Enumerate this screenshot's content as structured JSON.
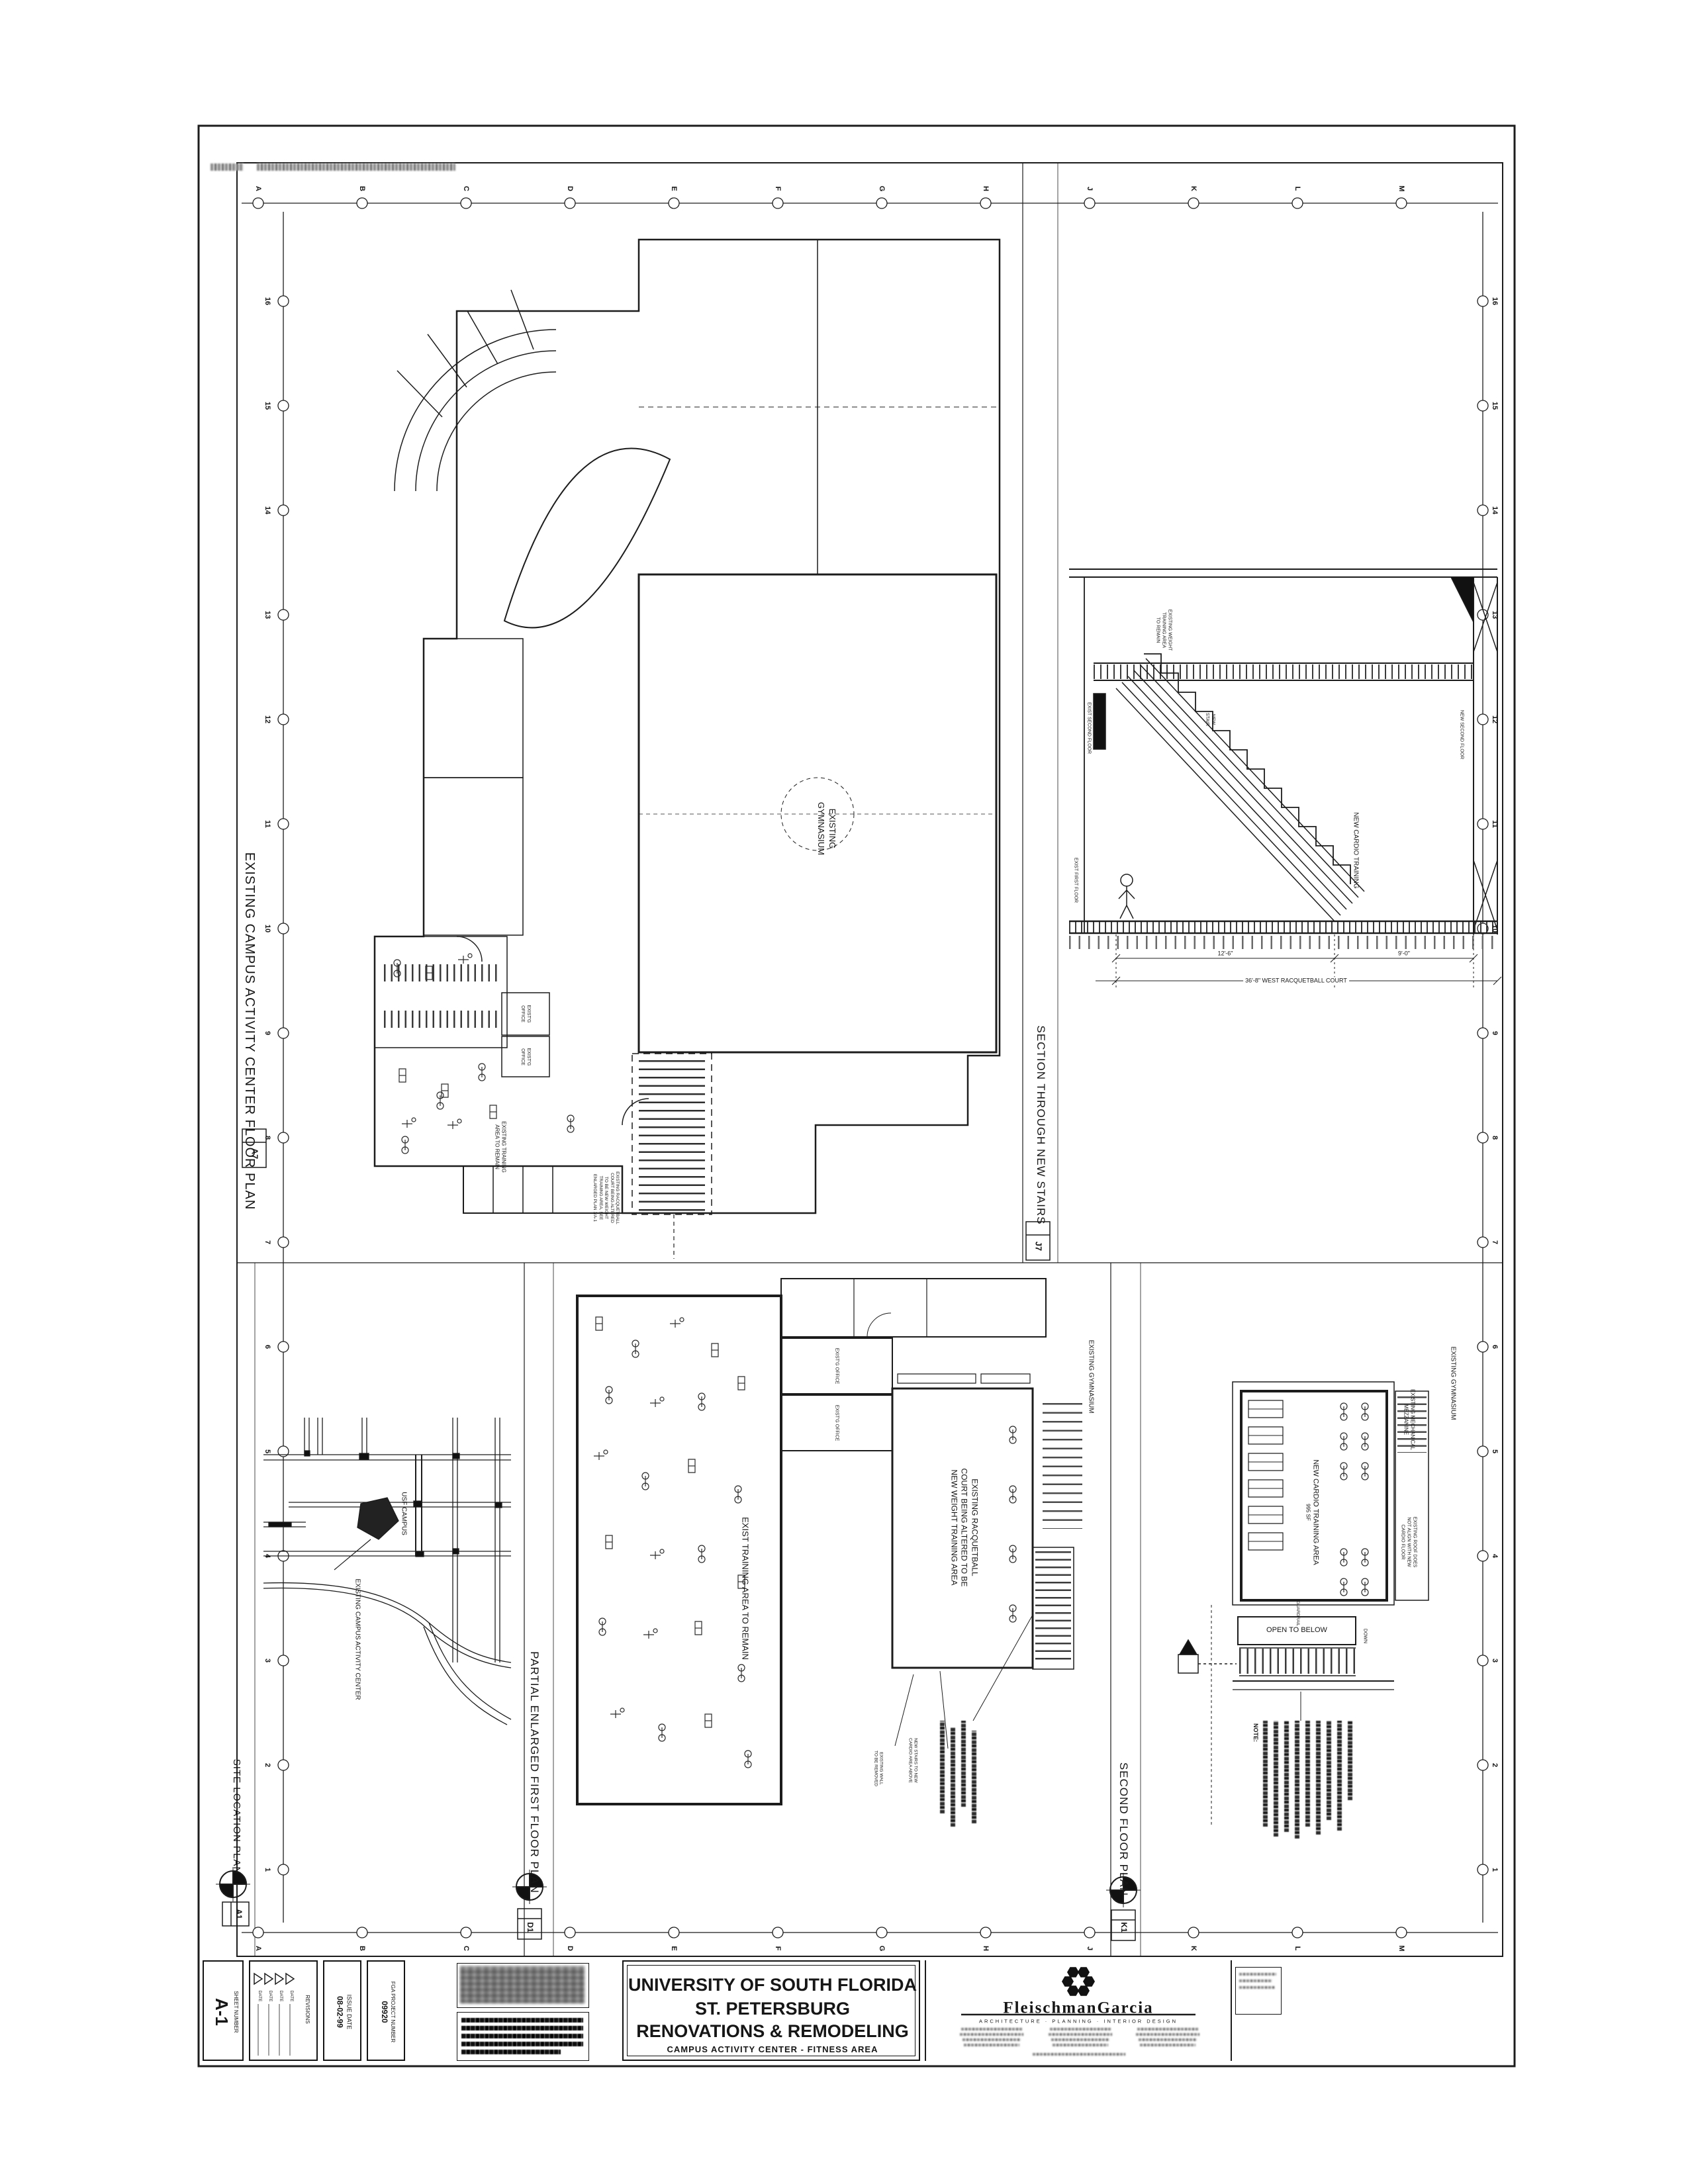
{
  "grid": {
    "letters": [
      "A",
      "B",
      "C",
      "D",
      "E",
      "F",
      "G",
      "H",
      "J",
      "K",
      "L",
      "M"
    ],
    "numbers": [
      "16",
      "15",
      "14",
      "13",
      "12",
      "11",
      "10",
      "9",
      "8",
      "7",
      "6",
      "5",
      "4",
      "3",
      "2",
      "1"
    ]
  },
  "floor_plan": {
    "title": "EXISTING CAMPUS ACTIVITY CENTER FLOOR PLAN",
    "ref": "A7",
    "gym_line1": "EXISTING",
    "gym_line2": "GYMNASIUM",
    "office_line1": "EXIST'G",
    "office_line2": "OFFICE",
    "training_line1": "EXISTING TRAINING",
    "training_line2": "AREA TO REMAIN",
    "racq_line1": "EXISTING RACQUETBALL",
    "racq_line2": "COURT BEING ALTERED",
    "racq_line3": "TO BE NEW WEIGHT",
    "racq_line4": "TRAINING AREA, SEE",
    "racq_line5": "ENLARGED PLAN 1/A-1"
  },
  "section": {
    "title": "SECTION THROUGH NEW STAIRS",
    "ref": "J7",
    "weight_line1": "EXISTING WEIGHT",
    "weight_line2": "TRAINING AREA",
    "weight_line3": "TO REMAIN",
    "new_stair_line1": "NEW",
    "new_stair_line2": "STAIR",
    "new_cardio": "NEW CARDIO TRAINING",
    "exist_second_floor": "EXIST SECOND FLOOR",
    "new_second_floor": "NEW SECOND FLOOR",
    "exist_first_floor": "EXIST FIRST FLOOR",
    "dim_run": "12'-6\"",
    "dim_land": "9'-0\"",
    "dim_overall": "36'-8\" WEST RACQUETBALL COURT"
  },
  "site_plan": {
    "title": "SITE LOCATION PLAN",
    "ref": "A1",
    "usf_campus": "USF CAMPUS",
    "existing_cac": "EXISTING CAMPUS ACTIVITY CENTER"
  },
  "enlarged_plan": {
    "title": "PARTIAL ENLARGED FIRST FLOOR PLAN",
    "ref": "D1",
    "train_area": "EXIST TRAINING AREA TO REMAIN",
    "court_line1": "EXISTING RACQUETBALL",
    "court_line2": "COURT BEING ALTERED TO BE",
    "court_line3": "NEW WEIGHT TRAINING AREA",
    "office": "EXIST'G OFFICE",
    "gym": "EXISTING GYMNASIUM",
    "note_stairs_line1": "NEW STAIRS TO NEW",
    "note_stairs_line2": "CARDIO AREA ABOVE",
    "note_wall_line1": "EXISTING WALL",
    "note_wall_line2": "TO BE REMOVED"
  },
  "second_floor": {
    "title": "SECOND FLOOR PLAN",
    "ref": "K1",
    "cardio_line1": "NEW CARDIO TRAINING AREA",
    "cardio_sf": "995 SF",
    "open_to_below": "OPEN TO BELOW",
    "down": "DOWN",
    "guardrail": "GUARDRAIL",
    "mezz_line1": "EXISTING MECHANICAL",
    "mezz_line2": "MEZZANINE",
    "gym": "EXISTING GYMNASIUM",
    "roof_note_line1": "EXISTING ROOF DOES",
    "roof_note_line2": "NOT ALIGN WITH NEW",
    "roof_note_line3": "CARDIO FLOOR",
    "note_header": "NOTE:"
  },
  "title_block": {
    "sheet_number_label": "SHEET NUMBER",
    "sheet_number": "A-1",
    "revisions_label": "REVISIONS",
    "date_label": "DATE",
    "issue_date_label": "ISSUE DATE",
    "issue_date": "08-02-99",
    "project_number_label": "FGA PROJECT NUMBER",
    "project_number": "09920",
    "project_line1": "UNIVERSITY OF SOUTH FLORIDA",
    "project_line2": "ST. PETERSBURG",
    "project_line3": "RENOVATIONS & REMODELING",
    "project_subtitle": "CAMPUS ACTIVITY CENTER - FITNESS AREA",
    "firm_name": "FleischmanGarcia",
    "firm_tagline": "ARCHITECTURE · PLANNING · INTERIOR DESIGN"
  }
}
